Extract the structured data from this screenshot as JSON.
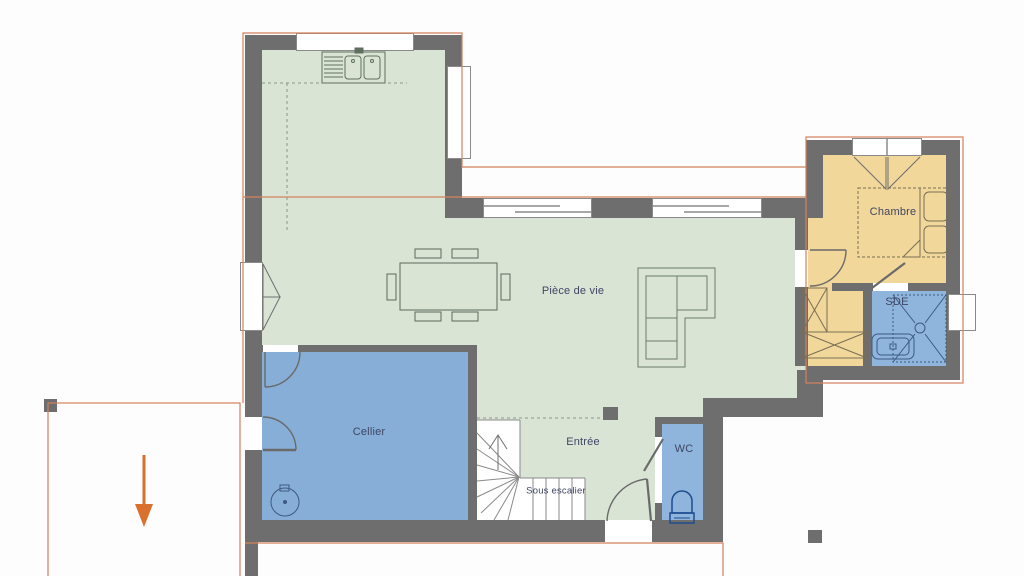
{
  "plan": {
    "title": "Floor plan — ground floor",
    "rooms": {
      "living": {
        "label": "Pièce de vie"
      },
      "bedroom": {
        "label": "Chambre"
      },
      "shower_room": {
        "label": "SDE"
      },
      "pantry": {
        "label": "Cellier"
      },
      "entrance": {
        "label": "Entrée"
      },
      "wc": {
        "label": "WC"
      },
      "under_stairs": {
        "label": "Sous escalier"
      }
    },
    "colors": {
      "wall_gray": "#6e6e6e",
      "floor_living": "#d9e4d5",
      "floor_wet": "#87aed7",
      "floor_bedroom": "#f2d79a",
      "roof_outline": "#d4815b",
      "arrow_orange": "#d9702e",
      "label_text": "#3e4663",
      "fixture_blue": "#1f4c8f"
    },
    "symbols": {
      "entrance_arrow": "down-arrow",
      "stairs": "winder-staircase",
      "kitchen_sink": "double-sink-with-drainer",
      "shower": "shower-tray-with-drain",
      "water_heater": "round-tank"
    }
  }
}
